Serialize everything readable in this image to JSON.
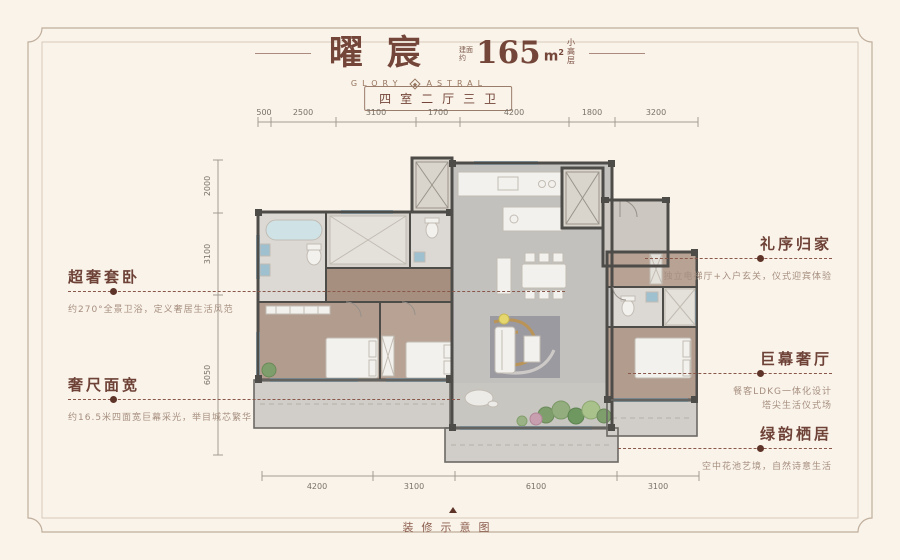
{
  "header": {
    "title": "曜宸",
    "subtitle_en_left": "GLORY",
    "subtitle_en_right": "ASTRAL",
    "area_prefix_top": "建面",
    "area_prefix_bottom": "约",
    "area_value": "165",
    "area_unit": "m",
    "area_sup": "2",
    "suffix": [
      "小",
      "高",
      "层"
    ],
    "badge": "四室二厅三卫"
  },
  "dimensions": {
    "top": [
      "500",
      "2500",
      "3100",
      "1700",
      "4200",
      "1800",
      "3200"
    ],
    "left": [
      "2000",
      "3100",
      "6050"
    ],
    "bottom": [
      "4200",
      "3100",
      "6100",
      "3100"
    ]
  },
  "features_left": [
    {
      "title": "超奢套卧",
      "desc": "约270°全景卫浴，定义奢居生活风范"
    },
    {
      "title": "奢尺面宽",
      "desc": "约16.5米四面宽巨幕采光，举目城芯繁华"
    }
  ],
  "features_right": [
    {
      "title": "礼序归家",
      "desc": "独立电梯厅+入户玄关，仪式迎宾体验",
      "desc2": ""
    },
    {
      "title": "巨幕奢厅",
      "desc": "餐客LDKG一体化设计",
      "desc2": "塔尖生活仪式场"
    },
    {
      "title": "绿韵栖居",
      "desc": "空中花池艺境，自然诗意生活",
      "desc2": ""
    }
  ],
  "footer": {
    "caption": "装修示意图"
  },
  "colors": {
    "background": "#faf3e9",
    "frame": "#bfae9c",
    "title_brown": "#74463a",
    "annotation_red": "#8a584a",
    "wall_dark": "#4e4c49",
    "living_floor": "#c3c1be",
    "wood_floor": "#b29c8e",
    "window_blue": "#a3c3d3"
  }
}
